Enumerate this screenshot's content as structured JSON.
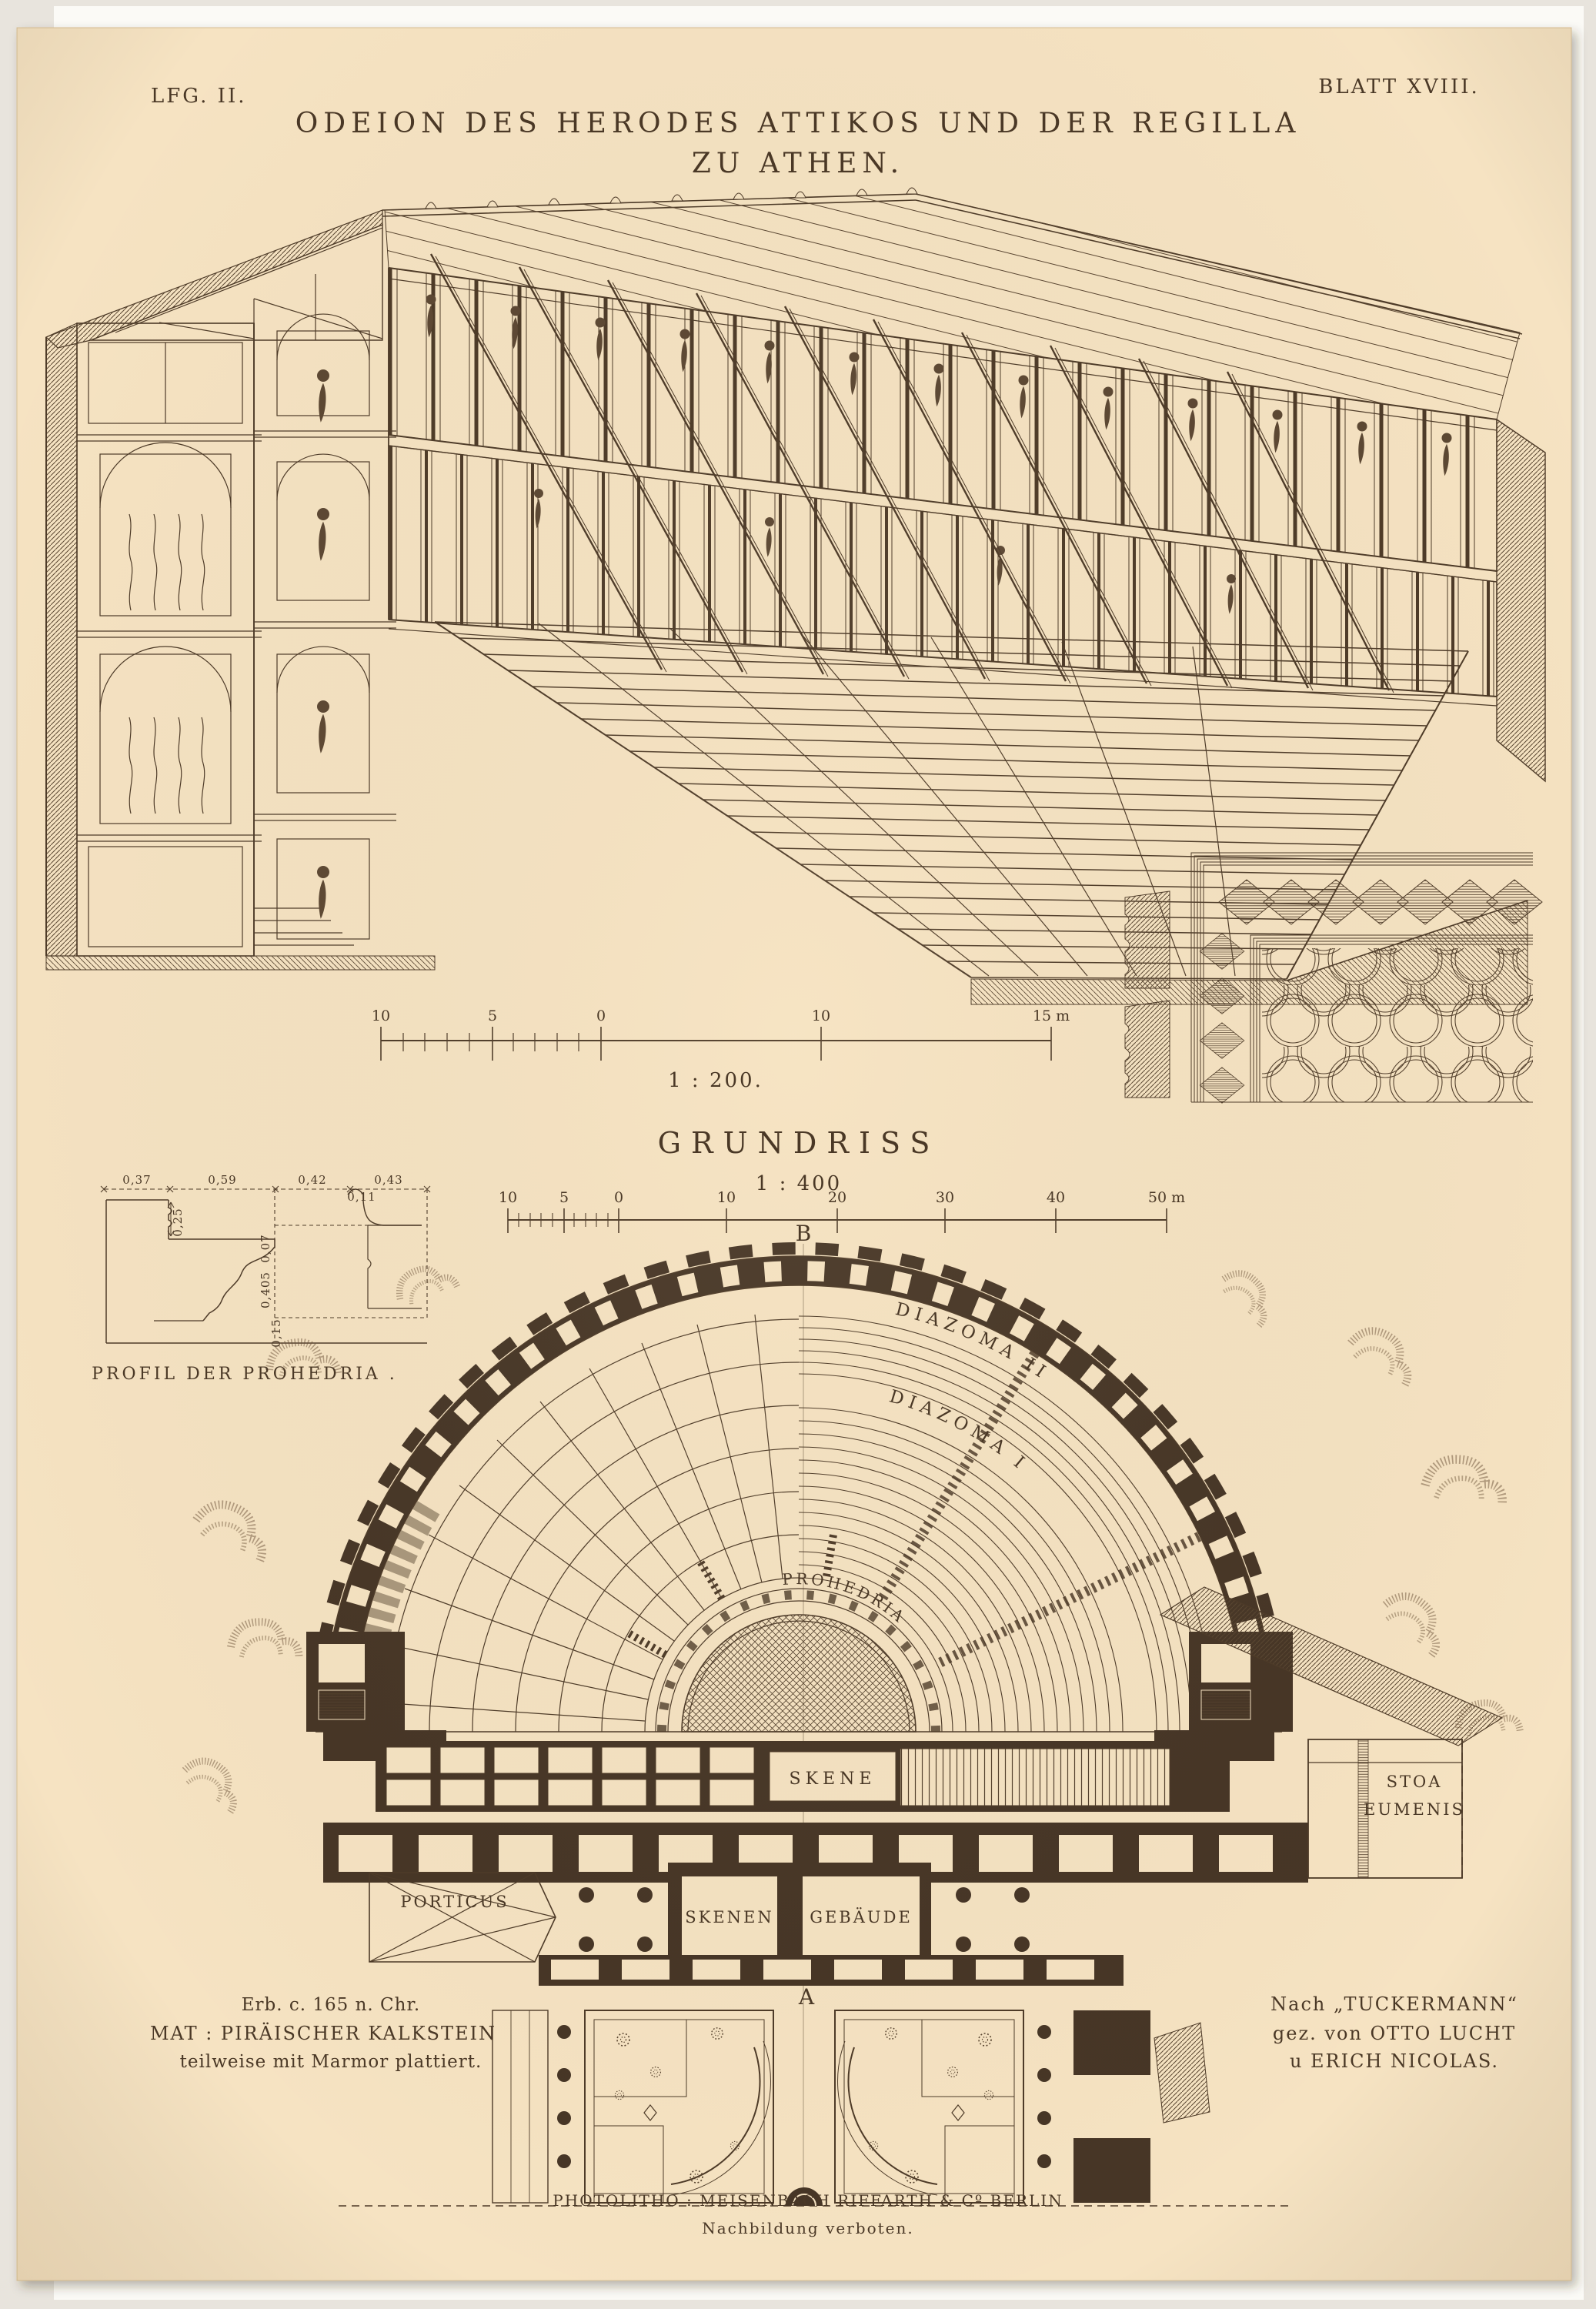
{
  "plate": {
    "series": "LFG. II.",
    "sheet": "BLATT XVIII.",
    "title_line1": "ODEION DES HERODES ATTIKOS UND DER REGILLA",
    "title_line2": "ZU ATHEN."
  },
  "section": {
    "scale_label": "1 : 200.",
    "ticks": [
      "10",
      "5",
      "0",
      "10",
      "15 m"
    ]
  },
  "plan": {
    "title": "GRUNDRISS",
    "scale_label": "1 : 400",
    "ticks": [
      "10",
      "5",
      "0",
      "10",
      "20",
      "30",
      "40",
      "50 m"
    ],
    "marker_top": "B",
    "marker_bottom": "A",
    "labels": {
      "diazoma_2": "DIAZOMA II",
      "diazoma_1": "DIAZOMA I",
      "prohedria": "PROHEDRIA",
      "skene": "SKENE",
      "skenen": "SKENEN",
      "gebaeude": "GEBÄUDE",
      "porticus": "PORTICUS",
      "stoa_line1": "STOA",
      "stoa_line2": "EUMENIS"
    }
  },
  "profil": {
    "caption": "PROFIL DER PROHEDRIA .",
    "dim_0": "0,37",
    "dim_1": "0,59",
    "dim_2": "0,42",
    "dim_3": "0,43",
    "dim_4": "0,25",
    "dim_5": "0,11",
    "dim_6": "0,07",
    "dim_7": "0,405",
    "dim_8": "0,15"
  },
  "notes_left": {
    "line1": "Erb. c. 165 n. Chr.",
    "line2": "MAT : PIRÄISCHER KALKSTEIN",
    "line3": "teilweise mit Marmor plattiert."
  },
  "notes_right": {
    "line1": "Nach „TUCKERMANN“",
    "line2": "gez. von OTTO LUCHT",
    "line3": "u ERICH NICOLAS."
  },
  "imprint": {
    "line1": "PHOTOLITHO :  MEISENBACH RIFFARTH & Cº BERLIN",
    "line2": "Nachbildung verboten."
  }
}
